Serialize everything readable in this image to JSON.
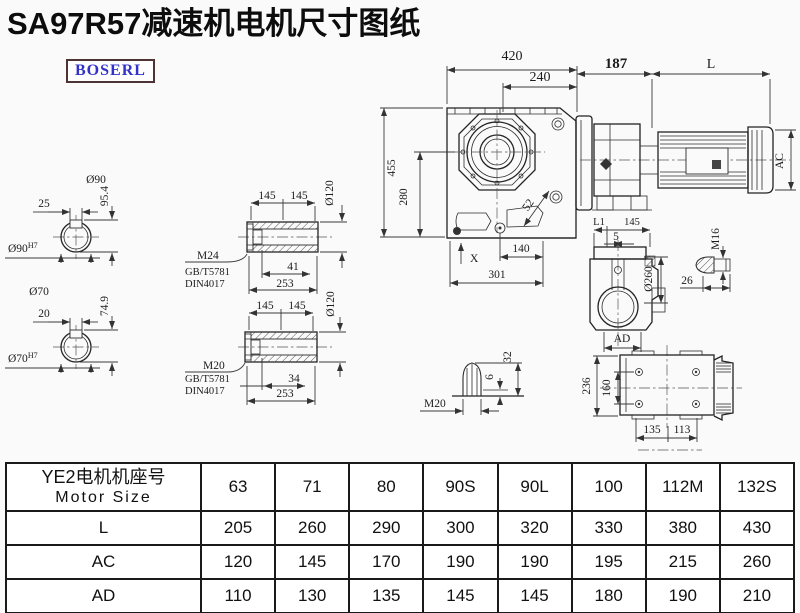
{
  "title": "SA97R57减速机电机尺寸图纸",
  "logo": {
    "text": "BOSERL",
    "text_color": "#3232c8",
    "border_color": "#4d3333"
  },
  "colors": {
    "line": "#2a2a2a",
    "background": "#fbfafa"
  },
  "dims": {
    "shaft_top": {
      "dia": "Ø90",
      "key": "25",
      "height": "95.4",
      "bore": "Ø90",
      "bore_sup": "H7"
    },
    "shaft_bottom": {
      "dia": "Ø70",
      "key": "20",
      "height": "74.9",
      "bore": "Ø70",
      "bore_sup": "H7"
    },
    "hollow_top": {
      "len_a": "145",
      "len_b": "145",
      "dia": "Ø120",
      "thread": "M24",
      "std1": "GB/T5781",
      "std2": "DIN4017",
      "bolt_len": "41",
      "total": "253"
    },
    "hollow_bottom": {
      "len_a": "145",
      "len_b": "145",
      "dia": "Ø120",
      "thread": "M20",
      "std1": "GB/T5781",
      "std2": "DIN4017",
      "bolt_len": "34",
      "total": "253"
    },
    "front": {
      "width": "420",
      "width_inner": "240",
      "height": "455",
      "height_inner": "280",
      "angle": "52",
      "x_mark": "X",
      "foot": "140",
      "base": "301"
    },
    "motor": {
      "flange": "187",
      "length": "L",
      "ac": "AC"
    },
    "side": {
      "l1": "L1",
      "len": "145",
      "offset": "5",
      "dia": "Ø260",
      "ad": "AD"
    },
    "bolt_m16": {
      "thread": "M16",
      "len": "26"
    },
    "bolt_m20": {
      "thread": "M20",
      "h_small": "6",
      "h_big": "32"
    },
    "top_view": {
      "height": "236",
      "holes_v": "160",
      "w_left": "135",
      "w_right": "113"
    }
  },
  "table": {
    "header_cn": "YE2电机机座号",
    "header_en": "Motor Size",
    "columns": [
      "63",
      "71",
      "80",
      "90S",
      "90L",
      "100",
      "112M",
      "132S"
    ],
    "rows": [
      {
        "label": "L",
        "values": [
          "205",
          "260",
          "290",
          "300",
          "320",
          "330",
          "380",
          "430"
        ]
      },
      {
        "label": "AC",
        "values": [
          "120",
          "145",
          "170",
          "190",
          "190",
          "195",
          "215",
          "260"
        ]
      },
      {
        "label": "AD",
        "values": [
          "110",
          "130",
          "135",
          "145",
          "145",
          "180",
          "190",
          "210"
        ]
      }
    ]
  }
}
